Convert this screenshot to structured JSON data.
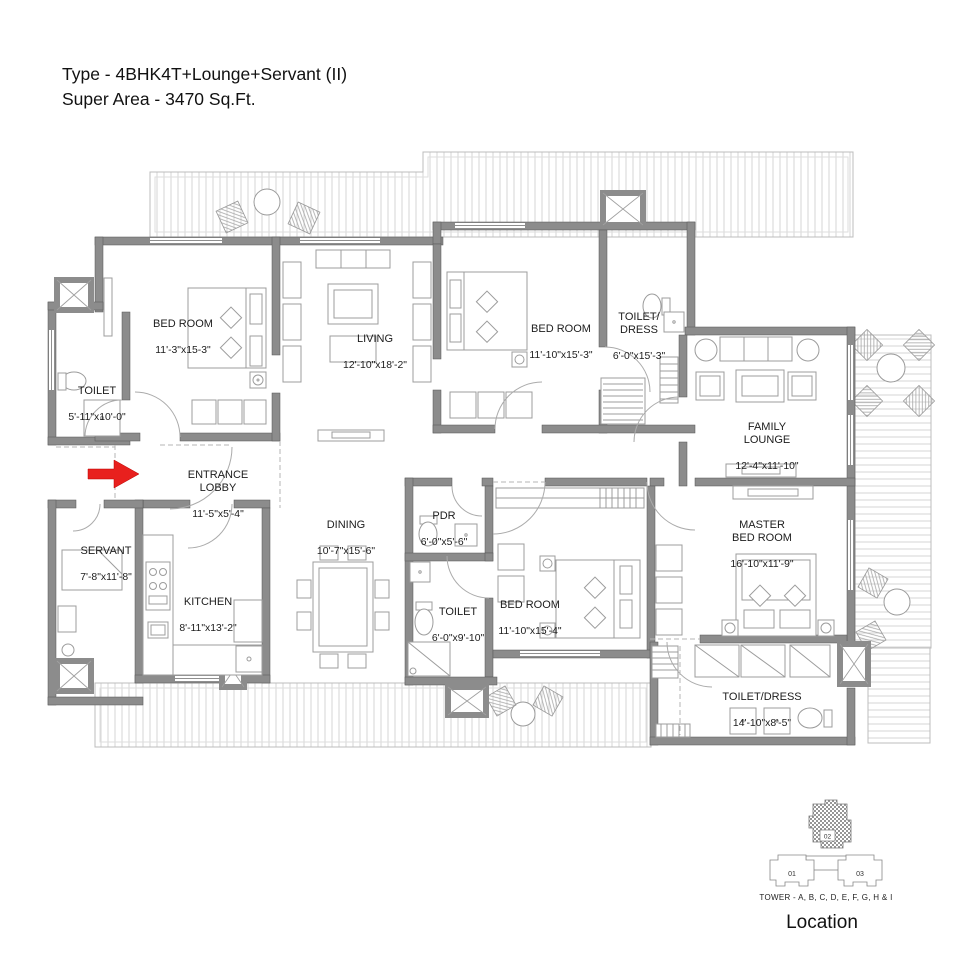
{
  "header": {
    "title_line1": "Type - 4BHK4T+Lounge+Servant (II)",
    "title_line2": "Super Area - 3470 Sq.Ft."
  },
  "rooms": [
    {
      "id": "bedroom-1",
      "name": "BED ROOM",
      "dims": "11'-3\"x15-3\""
    },
    {
      "id": "toilet-top-left",
      "name": "TOILET",
      "dims": "5'-11\"x10'-0\""
    },
    {
      "id": "living",
      "name": "LIVING",
      "dims": "12'-10\"x18'-2\""
    },
    {
      "id": "bedroom-2",
      "name": "BED ROOM",
      "dims": "11'-10\"x15'-3\""
    },
    {
      "id": "toilet-dress-top",
      "name": "TOILET/\nDRESS",
      "dims": "6'-0\"x15'-3\""
    },
    {
      "id": "family-lounge",
      "name": "FAMILY\nLOUNGE",
      "dims": "12'-4\"x11'-10\""
    },
    {
      "id": "entrance-lobby",
      "name": "ENTRANCE\nLOBBY",
      "dims": "11'-5\"x5'-4\""
    },
    {
      "id": "servant",
      "name": "SERVANT",
      "dims": "7'-8\"x11'-8\""
    },
    {
      "id": "kitchen",
      "name": "KITCHEN",
      "dims": "8'-11\"x13'-2\""
    },
    {
      "id": "dining",
      "name": "DINING",
      "dims": "10'-7\"x15'-6\""
    },
    {
      "id": "pdr",
      "name": "PDR",
      "dims": "6'-0\"x5'-6\""
    },
    {
      "id": "toilet-mid",
      "name": "TOILET",
      "dims": "6'-0\"x9'-10\""
    },
    {
      "id": "bedroom-3",
      "name": "BED ROOM",
      "dims": "11'-10\"x15'-4\""
    },
    {
      "id": "master-bedroom",
      "name": "MASTER\nBED ROOM",
      "dims": "16'-10\"x11'-9\""
    },
    {
      "id": "toilet-dress-bottom",
      "name": "TOILET/DRESS",
      "dims": "14'-10\"x8'-5\""
    }
  ],
  "location": {
    "unit01": "01",
    "unit02": "02",
    "unit03": "03",
    "caption": "TOWER - A, B, C, D, E, F, G, H & I",
    "label": "Location"
  },
  "colors": {
    "entrance_arrow": "#e8201e",
    "wall": "#8c8c8c"
  }
}
